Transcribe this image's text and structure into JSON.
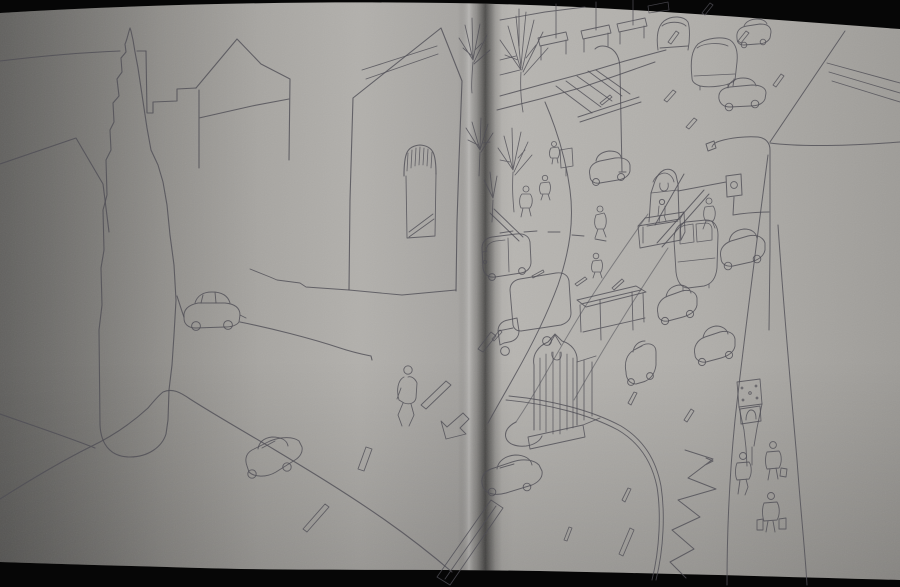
{
  "image": {
    "type": "photograph",
    "description": "Open sketchbook spread photographed on a black background. Pencil sketches: left page shows a street corner with a tall church tower, gabled houses, an arched shop doorway, curbs, lane dashes, a turn arrow, two sedans and a pedestrian. Right page shows a bird's-eye view of a busy avenue: storefront facades, zebra crossing, curved lampposts, a traffic signal, a median strip with a fountain monument, a bus shelter and a gothic monument, box truck, delivery van, minibuses and sedans, a street clock on a post, zigzag road marking, bare trees and pedestrians carrying bags.",
    "colors": {
      "background": "#060606",
      "paper_light": "#bab8b4",
      "paper_mid": "#a9a7a3",
      "paper_dark": "#7d7c79",
      "gutter_shadow": "#3f3e3c",
      "page_edge_highlight": "#d2d0cc",
      "pencil": "#4f4e55"
    },
    "left_page": {
      "items": [
        "church tower with wavy spire",
        "rooftop skyline line",
        "stepped parapet wall",
        "small gabled house",
        "large gabled house with arched awning doorway",
        "street corner curb curve",
        "sedan driving on upper street",
        "sedan at bottom",
        "walking pedestrian",
        "outlined turn arrow",
        "outlined lane dashes and crosswalk stripe",
        "bare trees near gutter"
      ]
    },
    "right_page": {
      "items": [
        "storefront facades with awnings",
        "zebra crosswalk and stop line",
        "curved lamppost",
        "lamppost with traffic signal",
        "median fountain monument with statue",
        "bus shelter on median",
        "gothic median monument with columns",
        "delivery van",
        "box truck",
        "front-facing minibus",
        "five sedans",
        "sedan crossing the gutter",
        "street clock box on post",
        "zigzag road marking",
        "three pedestrians on right sidewalk",
        "pedestrians crossing street",
        "bare street trees",
        "scattered lane dashes"
      ]
    }
  }
}
